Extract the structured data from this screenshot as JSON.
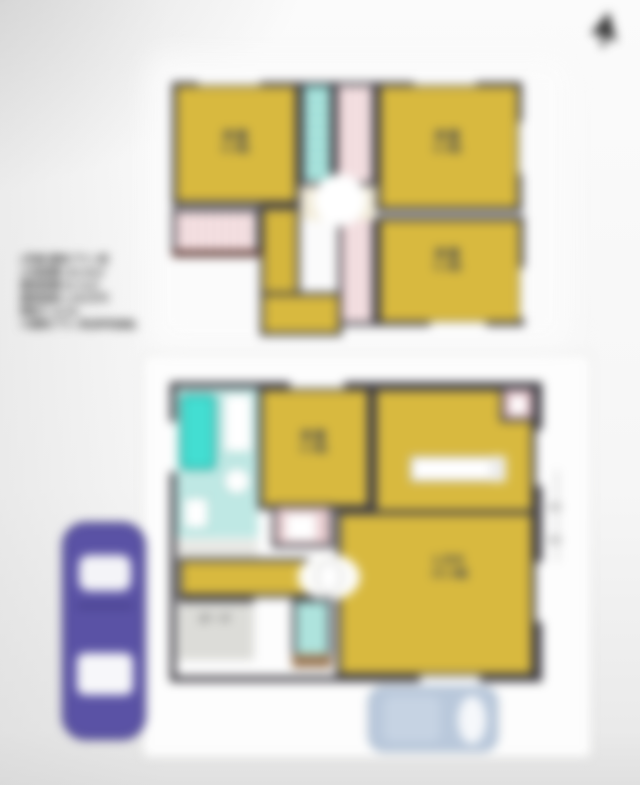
{
  "photo": {
    "description": "blurred real-estate floor plan photo",
    "cursor_icon": "mouse-cursor-arrow"
  },
  "info_block": {
    "lines": [
      "2号棟 建物プラン例",
      "土地面積:100.08㎡",
      "建物面積:93.15㎡",
      "建物価格:1,650万円",
      "間取り:4LDK",
      "※建物プラン例(参考価格)"
    ]
  },
  "floor2": {
    "rooms": [
      {
        "label": "洋室",
        "size": "6.0帖"
      },
      {
        "label": "洋室",
        "size": "6.0帖"
      },
      {
        "label": "洋室",
        "size": "5.2帖"
      }
    ]
  },
  "floor1": {
    "rooms": [
      {
        "label": "洋室",
        "size": "4.5帖"
      },
      {
        "label": "LDK",
        "size": "15.2帖"
      }
    ],
    "porch_label": "ポーチ"
  },
  "colors": {
    "room_yellow": "#d8b93f",
    "wall": "#3f3d44",
    "teal_fixture": "#43ded2",
    "teal_light": "#aee3dd",
    "closet_pink": "#ecccd0",
    "car_purple": "#5a52a5",
    "car_blue": "#b9c8db",
    "entry_step_brown": "#9c7a58"
  }
}
